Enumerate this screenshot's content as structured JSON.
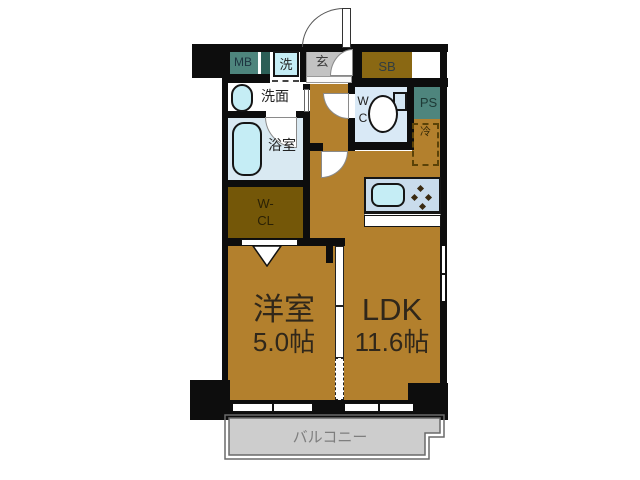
{
  "title": "1LDK apartment floor plan",
  "labels": {
    "mb": "MB",
    "washer": "洗",
    "entrance": "玄",
    "shoe_box": "SB",
    "pipe_space": "PS",
    "washroom": "洗面",
    "toilet_w": "W",
    "toilet_c": "C",
    "bathroom": "浴室",
    "closet_line1": "W-",
    "closet_line2": "CL",
    "refrigerator": "冷",
    "western_room_name": "洋室",
    "western_room_size": "5.0帖",
    "ldk_name": "LDK",
    "ldk_size": "11.6帖",
    "balcony": "バルコニー"
  },
  "colors": {
    "wall": "#0D0D0D",
    "room_brown": "#B3802D",
    "closet_brown": "#745708",
    "shoe_box_brown": "#8A6813",
    "utility_teal": "#4E857D",
    "shaft_teal": "#2C5F57",
    "fixture_cyan": "#C5EDF5",
    "bath_blue": "#D9E9F2",
    "toilet_blue": "#D9E9F6",
    "kitchen_blue": "#C9DCEC",
    "entrance_gray": "#C2C2C2",
    "balcony_gray": "#CDCDCD",
    "label_dark": "#30271A"
  }
}
